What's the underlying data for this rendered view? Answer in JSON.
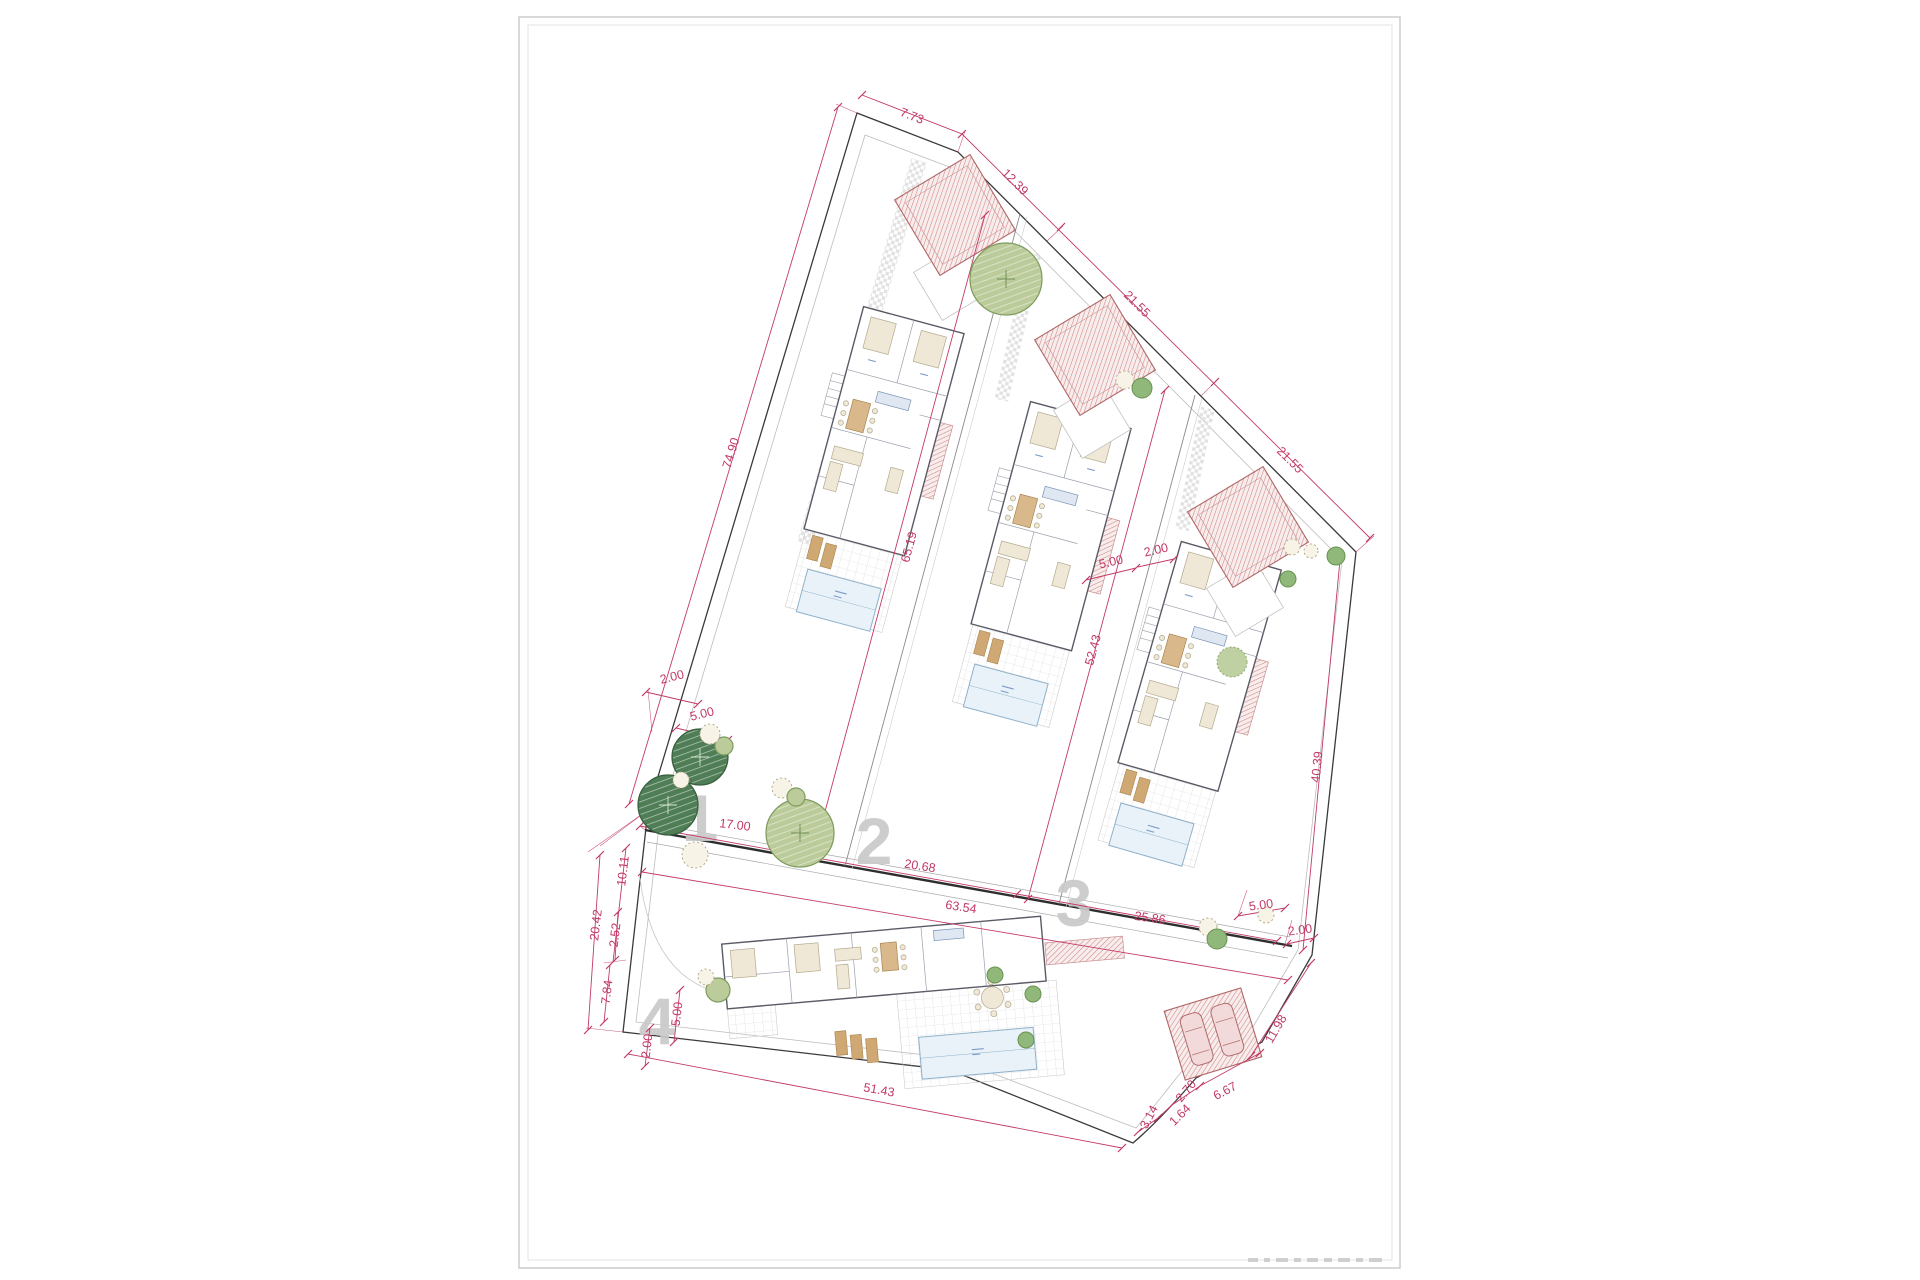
{
  "drawing": {
    "kind": "architectural site plan",
    "plots_visible": 4
  },
  "colors": {
    "dimension": "#c23a67",
    "boundary": "#3a3a3a",
    "wall": "#5a5a66",
    "hatch_red": "#d08484",
    "hatch_fill": "#f8eded",
    "tree_light": "#bccb9a",
    "tree_outline": "#7e9b5e",
    "tree_dark": "#4f7d55",
    "pool": "#e9f2f9",
    "pool_border": "#8fb0c9",
    "plot_number": "#c9c9c9",
    "blue_note": "#7b9cc9"
  },
  "plot_numbers": [
    {
      "label": "1",
      "x": 700,
      "y": 818
    },
    {
      "label": "2",
      "x": 874,
      "y": 841
    },
    {
      "label": "3",
      "x": 1074,
      "y": 903
    },
    {
      "label": "4",
      "x": 657,
      "y": 1021
    }
  ],
  "dimension_labels": [
    {
      "label": "7.73",
      "x": 912,
      "y": 116,
      "rot": 21
    },
    {
      "label": "12.39",
      "x": 1015,
      "y": 182,
      "rot": 45
    },
    {
      "label": "21.55",
      "x": 1137,
      "y": 304,
      "rot": 45
    },
    {
      "label": "21.55",
      "x": 1290,
      "y": 460,
      "rot": 45
    },
    {
      "label": "74.90",
      "x": 731,
      "y": 453,
      "rot": -73
    },
    {
      "label": "65.19",
      "x": 909,
      "y": 547,
      "rot": -75
    },
    {
      "label": "52.43",
      "x": 1093,
      "y": 650,
      "rot": -75
    },
    {
      "label": "40.39",
      "x": 1317,
      "y": 767,
      "rot": -84
    },
    {
      "label": "2.00",
      "x": 672,
      "y": 677,
      "rot": -14
    },
    {
      "label": "5.00",
      "x": 702,
      "y": 714,
      "rot": -14
    },
    {
      "label": "5.00",
      "x": 1111,
      "y": 562,
      "rot": -13
    },
    {
      "label": "2.00",
      "x": 1156,
      "y": 550,
      "rot": -13
    },
    {
      "label": "17.00",
      "x": 735,
      "y": 825,
      "rot": 7
    },
    {
      "label": "20.68",
      "x": 920,
      "y": 866,
      "rot": 9
    },
    {
      "label": "63.54",
      "x": 961,
      "y": 907,
      "rot": 9
    },
    {
      "label": "25.86",
      "x": 1150,
      "y": 918,
      "rot": 8
    },
    {
      "label": "10.11",
      "x": 623,
      "y": 871,
      "rot": -83
    },
    {
      "label": "20.42",
      "x": 596,
      "y": 925,
      "rot": -83
    },
    {
      "label": "2.52",
      "x": 615,
      "y": 935,
      "rot": -83
    },
    {
      "label": "7.84",
      "x": 607,
      "y": 992,
      "rot": -83
    },
    {
      "label": "5.00",
      "x": 677,
      "y": 1014,
      "rot": -83
    },
    {
      "label": "2.00",
      "x": 647,
      "y": 1046,
      "rot": -83
    },
    {
      "label": "51.43",
      "x": 879,
      "y": 1090,
      "rot": 10
    },
    {
      "label": "5.00",
      "x": 1261,
      "y": 905,
      "rot": -8
    },
    {
      "label": "2.00",
      "x": 1300,
      "y": 930,
      "rot": -8
    },
    {
      "label": "11.98",
      "x": 1276,
      "y": 1029,
      "rot": -60
    },
    {
      "label": "6.67",
      "x": 1225,
      "y": 1091,
      "rot": -28
    },
    {
      "label": "2.70",
      "x": 1186,
      "y": 1091,
      "rot": -50
    },
    {
      "label": "1.64",
      "x": 1180,
      "y": 1115,
      "rot": -45
    },
    {
      "label": "3.14",
      "x": 1149,
      "y": 1117,
      "rot": -62
    }
  ],
  "trees": [
    {
      "type": "light-large",
      "x": 1006,
      "y": 279,
      "r": 36
    },
    {
      "type": "light-large",
      "x": 800,
      "y": 833,
      "r": 34
    },
    {
      "type": "dark",
      "x": 700,
      "y": 757,
      "r": 28
    },
    {
      "type": "dark",
      "x": 668,
      "y": 805,
      "r": 30
    },
    {
      "type": "light",
      "x": 724,
      "y": 746,
      "r": 9
    },
    {
      "type": "dotted",
      "x": 710,
      "y": 734,
      "r": 10
    },
    {
      "type": "dotted",
      "x": 681,
      "y": 780,
      "r": 8
    },
    {
      "type": "dotted",
      "x": 782,
      "y": 788,
      "r": 10
    },
    {
      "type": "light",
      "x": 796,
      "y": 797,
      "r": 9
    },
    {
      "type": "dotted",
      "x": 695,
      "y": 855,
      "r": 13
    },
    {
      "type": "dotted",
      "x": 1125,
      "y": 380,
      "r": 9
    },
    {
      "type": "green",
      "x": 1142,
      "y": 388,
      "r": 10
    },
    {
      "type": "dotted",
      "x": 1292,
      "y": 547,
      "r": 8
    },
    {
      "type": "dotted",
      "x": 1311,
      "y": 551,
      "r": 7
    },
    {
      "type": "green",
      "x": 1336,
      "y": 556,
      "r": 9
    },
    {
      "type": "green",
      "x": 1288,
      "y": 579,
      "r": 8
    },
    {
      "type": "dotted",
      "x": 1208,
      "y": 927,
      "r": 9
    },
    {
      "type": "green",
      "x": 1217,
      "y": 939,
      "r": 10
    },
    {
      "type": "light",
      "x": 718,
      "y": 990,
      "r": 12
    },
    {
      "type": "dotted",
      "x": 706,
      "y": 977,
      "r": 8
    },
    {
      "type": "green",
      "x": 995,
      "y": 975,
      "r": 8
    },
    {
      "type": "green",
      "x": 1033,
      "y": 994,
      "r": 8
    },
    {
      "type": "green",
      "x": 1026,
      "y": 1040,
      "r": 8
    },
    {
      "type": "dotted",
      "x": 1266,
      "y": 915,
      "r": 8
    }
  ]
}
